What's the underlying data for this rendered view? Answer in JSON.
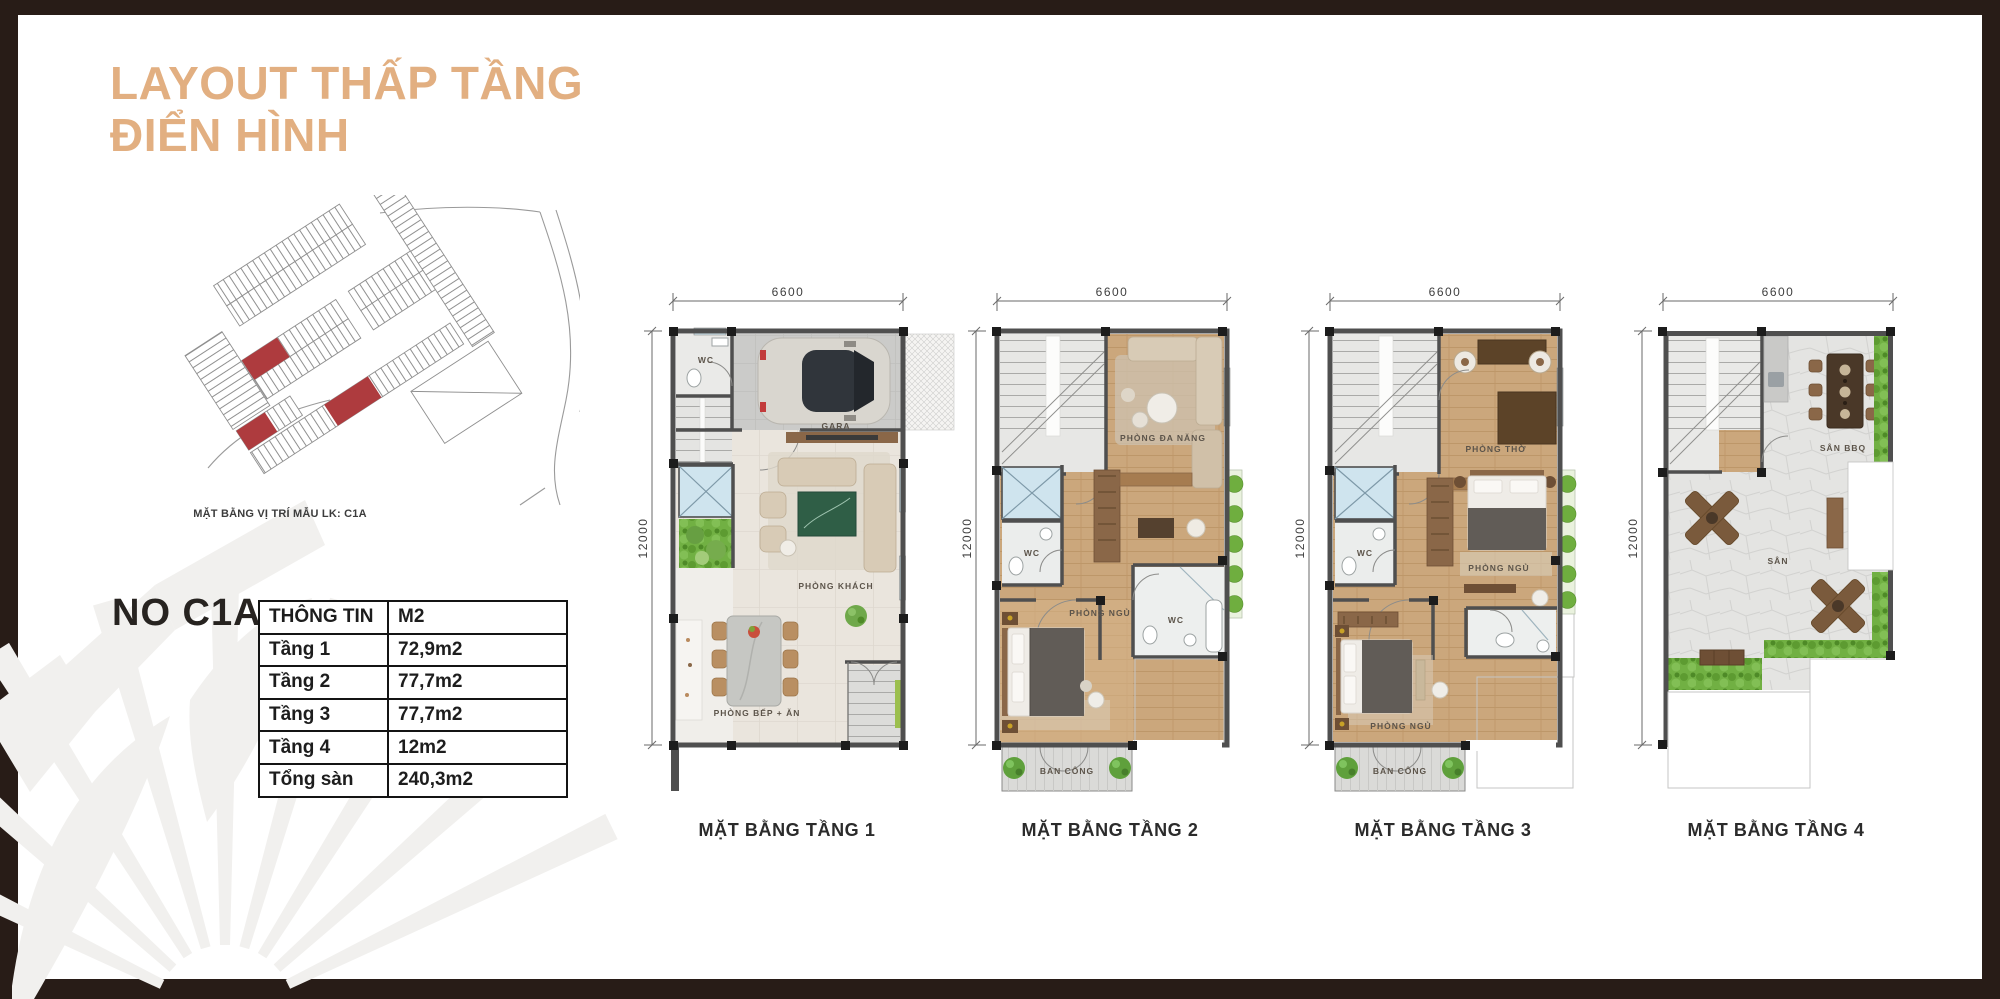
{
  "title": {
    "line1": "LAYOUT THẤP TẦNG",
    "line2": "ĐIỂN HÌNH",
    "color": "#E2AF81"
  },
  "site_map": {
    "caption": "MẶT BẰNG VỊ TRÍ MẪU LK: C1A",
    "highlight_color": "#AE3B3E"
  },
  "unit": {
    "name": "NO C1A",
    "info_table": {
      "col1_header": "THÔNG TIN",
      "col2_header": "M2",
      "rows": [
        {
          "label": "Tầng 1",
          "value": "72,9m2"
        },
        {
          "label": "Tầng 2",
          "value": "77,7m2"
        },
        {
          "label": "Tầng 3",
          "value": "77,7m2"
        },
        {
          "label": "Tầng 4",
          "value": "12m2"
        },
        {
          "label": "Tổng sàn",
          "value": "240,3m2"
        }
      ]
    }
  },
  "floor_plans": [
    {
      "label": "MẶT BẰNG TẦNG 1",
      "width_dim": "6600",
      "height_dim": "12000",
      "rooms": {
        "wc": "WC",
        "gara": "GARA",
        "living": "PHÒNG KHÁCH",
        "kitchen": "PHÒNG BẾP + ĂN"
      }
    },
    {
      "label": "MẶT BẰNG TẦNG 2",
      "width_dim": "6600",
      "height_dim": "12000",
      "rooms": {
        "multi": "PHÒNG ĐA NĂNG",
        "wc_left": "WC",
        "bedroom": "PHÒNG NGỦ",
        "wc_right": "WC",
        "balcony": "BAN CÔNG"
      }
    },
    {
      "label": "MẶT BẰNG TẦNG 3",
      "width_dim": "6600",
      "height_dim": "12000",
      "rooms": {
        "worship": "PHÒNG THỜ",
        "wc_left": "WC",
        "bedroom_mid": "PHÒNG NGỦ",
        "bedroom_bottom": "PHÒNG NGỦ",
        "balcony": "BAN CÔNG"
      }
    },
    {
      "label": "MẶT BẰNG TẦNG 4",
      "width_dim": "6600",
      "height_dim": "12000",
      "rooms": {
        "bbq": "SÂN BBQ",
        "yard": "SÂN"
      }
    }
  ]
}
